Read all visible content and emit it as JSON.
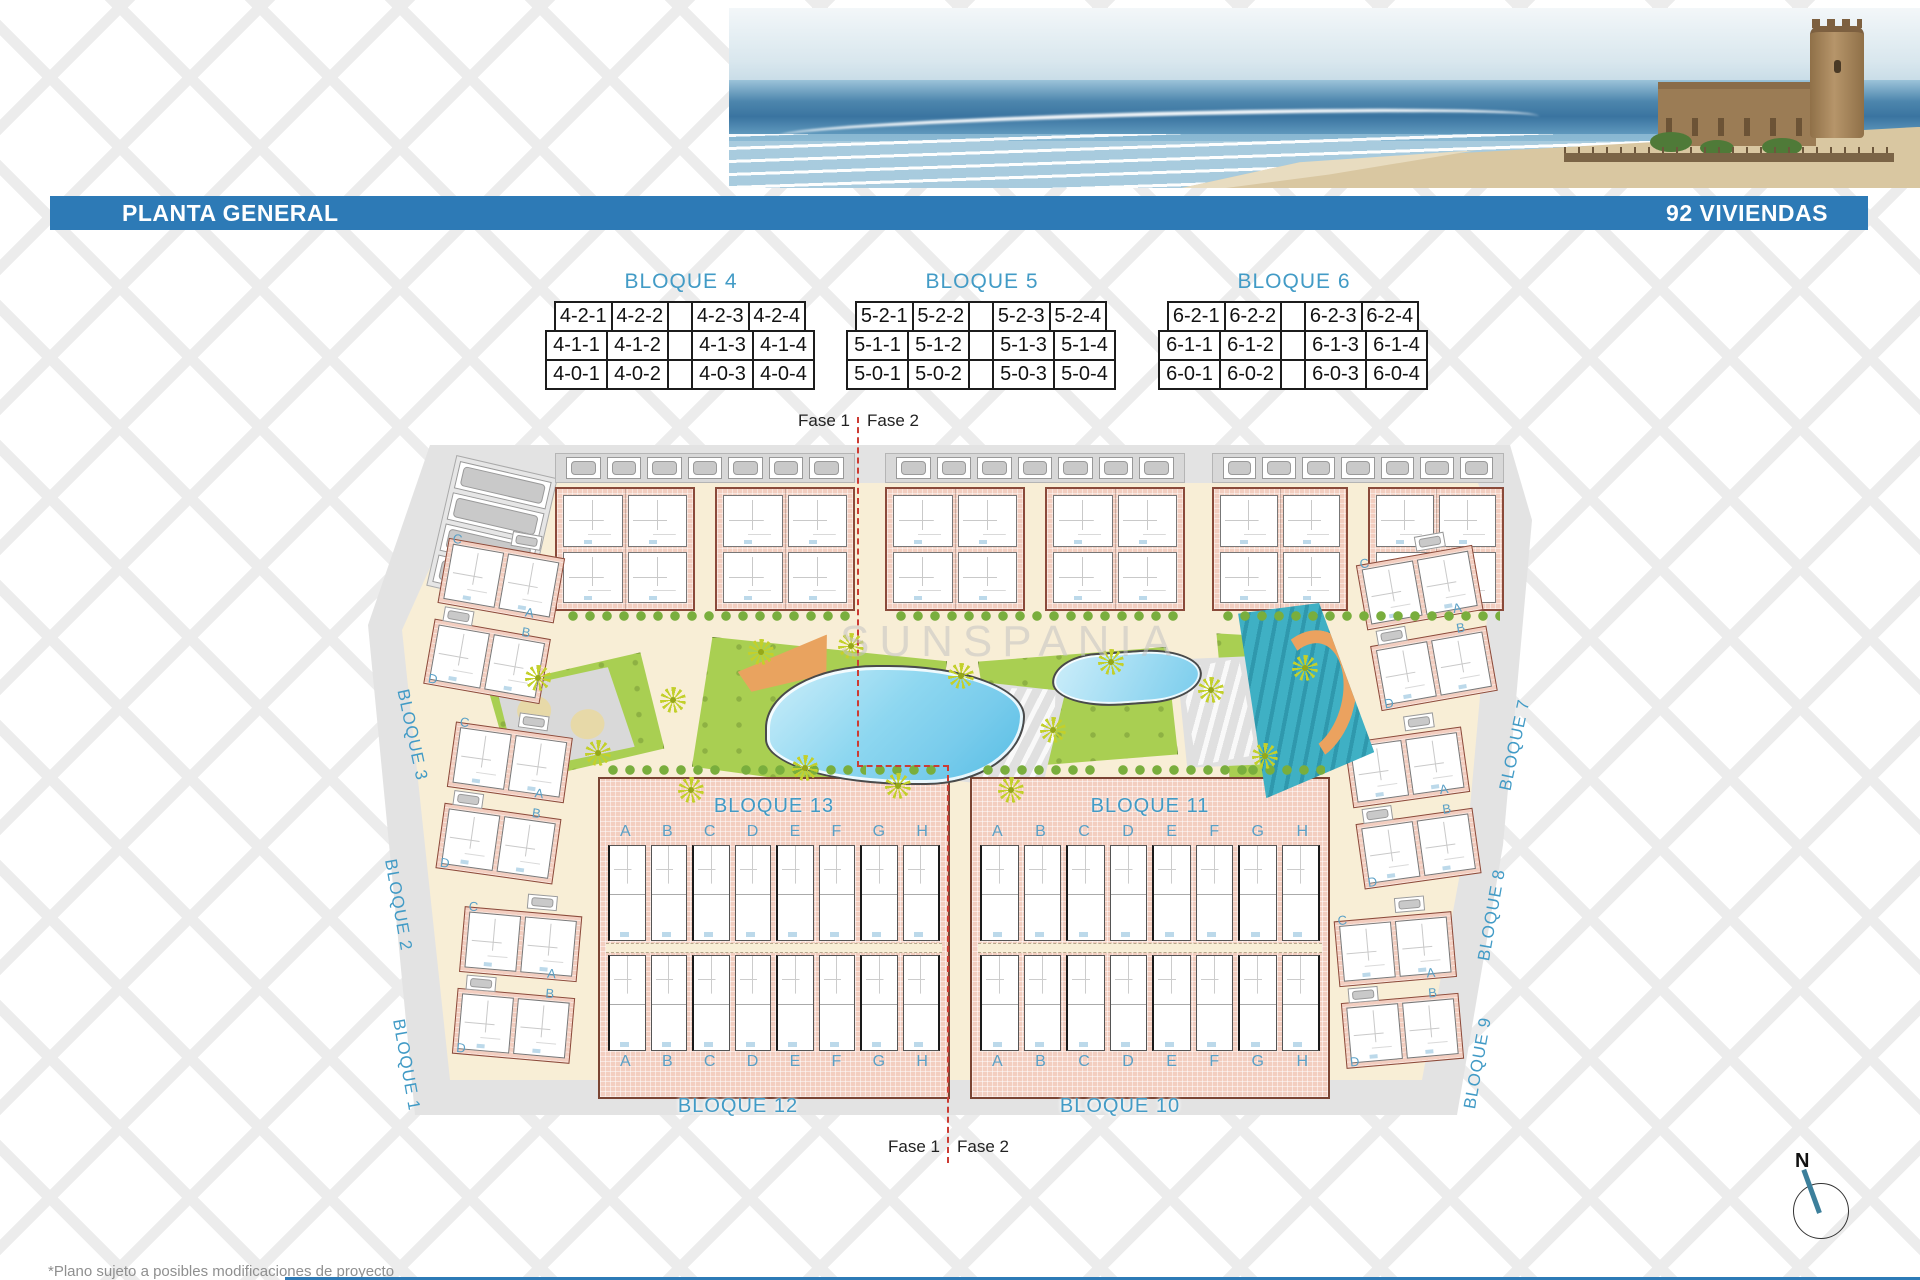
{
  "header": {
    "title": "PLANTA GENERAL",
    "units_count": "92 VIVIENDAS"
  },
  "unit_tables": [
    {
      "title": "BLOQUE 4",
      "rows": [
        [
          "4-2-1",
          "4-2-2",
          "",
          "4-2-3",
          "4-2-4"
        ],
        [
          "4-1-1",
          "4-1-2",
          "",
          "4-1-3",
          "4-1-4"
        ],
        [
          "4-0-1",
          "4-0-2",
          "",
          "4-0-3",
          "4-0-4"
        ]
      ]
    },
    {
      "title": "BLOQUE 5",
      "rows": [
        [
          "5-2-1",
          "5-2-2",
          "",
          "5-2-3",
          "5-2-4"
        ],
        [
          "5-1-1",
          "5-1-2",
          "",
          "5-1-3",
          "5-1-4"
        ],
        [
          "5-0-1",
          "5-0-2",
          "",
          "5-0-3",
          "5-0-4"
        ]
      ]
    },
    {
      "title": "BLOQUE 6",
      "rows": [
        [
          "6-2-1",
          "6-2-2",
          "",
          "6-2-3",
          "6-2-4"
        ],
        [
          "6-1-1",
          "6-1-2",
          "",
          "6-1-3",
          "6-1-4"
        ],
        [
          "6-0-1",
          "6-0-2",
          "",
          "6-0-3",
          "6-0-4"
        ]
      ]
    }
  ],
  "site_plan": {
    "watermark": "SUNSPANIA",
    "phase": {
      "fase1": "Fase 1",
      "fase2": "Fase 2"
    },
    "left_block_labels": [
      "BLOQUE 3",
      "BLOQUE 2",
      "BLOQUE 1"
    ],
    "right_block_labels": [
      "BLOQUE 7",
      "BLOQUE 8",
      "BLOQUE 9"
    ],
    "center_strips": [
      {
        "top_label": "BLOQUE 13",
        "bottom_label": "BLOQUE 12",
        "letters": [
          "A",
          "B",
          "C",
          "D",
          "E",
          "F",
          "G",
          "H"
        ]
      },
      {
        "top_label": "BLOQUE 11",
        "bottom_label": "BLOQUE 10",
        "letters": [
          "A",
          "B",
          "C",
          "D",
          "E",
          "F",
          "G",
          "H"
        ]
      }
    ],
    "side_unit_letters": [
      "C",
      "A",
      "B",
      "D"
    ],
    "compass": "N"
  },
  "footnote": "*Plano sujeto a posibles modificaciones de proyecto",
  "colors": {
    "title_bar": "#2d7ab6",
    "block_label": "#429bc6",
    "phase_line": "#cc3b33",
    "pool": "#79ccec",
    "lawn": "#a9cf52",
    "building": "#f3cec0",
    "road": "#e3e3e3",
    "sand": "#f8eed6"
  }
}
